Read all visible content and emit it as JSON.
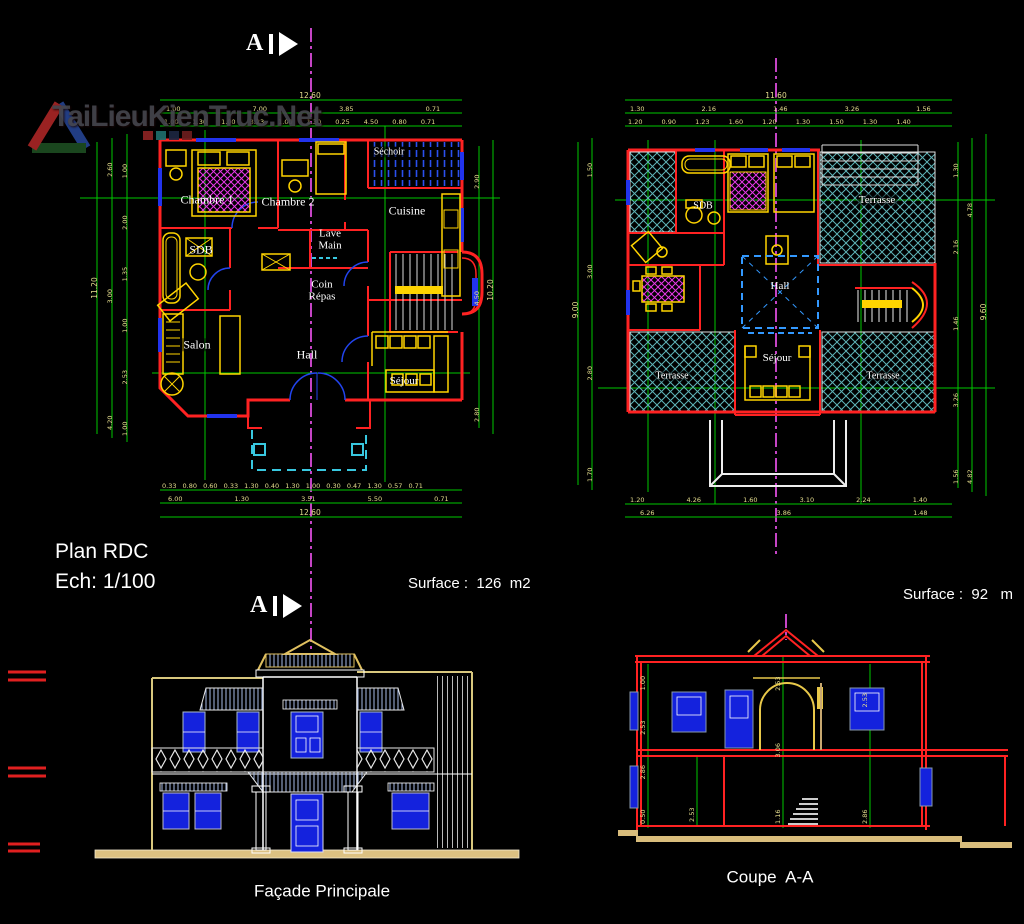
{
  "watermark": {
    "text": "TaiLieuKienTruc.Net"
  },
  "section_marker": {
    "label": "A"
  },
  "plan_rdc": {
    "title": "Plan RDC",
    "scale": "Ech: 1/100",
    "surface": "Surface :  126  m2",
    "rooms": {
      "chambre1": "Chambre 1",
      "chambre2": "Chambre 2",
      "sechoir": "Séchoir",
      "cuisine": "Cuisine",
      "sdb": "SDB",
      "lave_main": "Lave\nMain",
      "coin_repas": "Coin\nRépas",
      "salon": "Salon",
      "hall": "Hall",
      "sejour": "Séjour"
    }
  },
  "plan_etage": {
    "surface": "Surface :  92   m",
    "rooms": {
      "sdb": "SDB",
      "hall": "Hall",
      "sejour": "Séjour",
      "terrasse_ne": "Terrasse",
      "terrasse_sw": "Terrasse",
      "terrasse_se": "Terrasse"
    }
  },
  "facade": {
    "label": "Façade Principale"
  },
  "coupe": {
    "label": "Coupe  A-A"
  },
  "dims": {
    "rdc_top_total": "12.60",
    "rdc_top_mid": "1.00 7.00 3.85 0.71",
    "rdc_top_detail": "1.00 1.30 1.00 3.23 1.00 1.30 0.25 4.50 0.80 0.71",
    "rdc_bottom_detail": "0.33 0.80 0.60 0.33 1.30 0.40 1.30 1.00 0.30 0.47 1.30 0.57 0.71",
    "rdc_bottom_mid": "6.00 1.30 3.51 5.50 0.71",
    "rdc_bottom_total": "12.60",
    "rdc_left_outer": "11.20",
    "rdc_left_mid": "4.20 3.00 2.60",
    "rdc_left_inner": "1.00 2.53 1.00 1.35 2.00 1.00",
    "rdc_right_inner": "2.80 4.50 2.90",
    "rdc_right_outer": "10.20",
    "etage_top_total": "11.60",
    "etage_top_mid": "1.30 2.16 1.46 3.26 1.56",
    "etage_top_detail": "1.20 0.90 1.23 1.60 1.20 1.30 1.50 1.30 1.40",
    "etage_bottom_detail": "1.20 4.26 1.60 3.10 2.24 1.40",
    "etage_bottom_mid": "6.26 3.86 1.48",
    "etage_left_inner": "1.70 2.80 3.00 1.50",
    "etage_left_outer": "9.00",
    "etage_right_inner": "1.56 3.26 1.46 2.16 1.30",
    "etage_right_mid": "4.82 4.78",
    "etage_right_outer": "9.60",
    "coupe_left": "0.50 2.86 2.53 1.00",
    "coupe_inner": "2.53",
    "coupe_center": "1.16 3.06 2.53",
    "coupe_right": "2.86 2.53"
  },
  "colors": {
    "wall": "#ff2222",
    "furniture": "#ffd400",
    "window": "#2233ee",
    "dimension": "#00c800",
    "centerline": "#c544c5",
    "terrace_hatch": "#5fb4b8",
    "bed_hatch": "#e838e8",
    "ground": "#dcc182",
    "label_text": "#ffffff",
    "dim_text": "#e6de8e"
  }
}
